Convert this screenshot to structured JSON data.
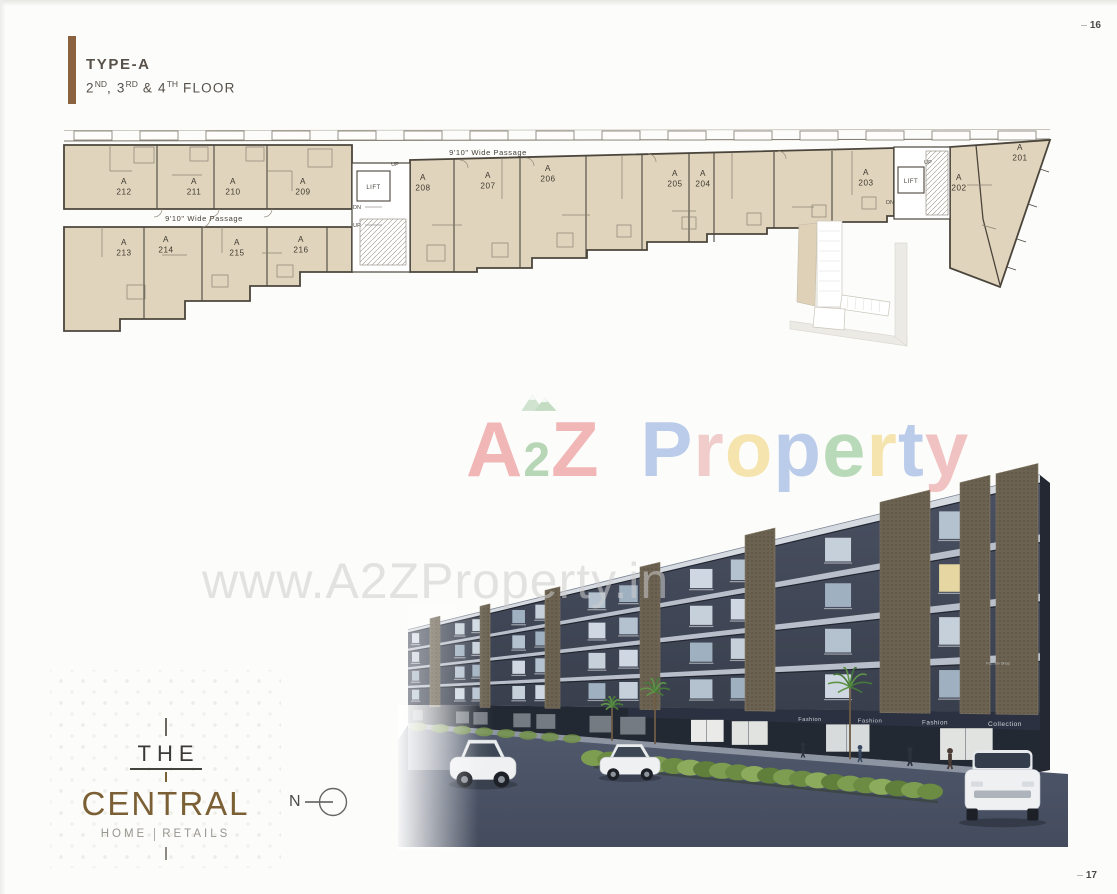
{
  "page": {
    "top_page_number": "16",
    "bottom_page_number": "17"
  },
  "header": {
    "title": "TYPE-A",
    "floor_parts": [
      {
        "text": "2",
        "sup": "ND"
      },
      {
        "text": ", 3",
        "sup": "RD"
      },
      {
        "text": " & 4",
        "sup": "TH"
      }
    ],
    "floor_suffix": " FLOOR",
    "accent_color": "#8a6240",
    "text_color": "#57514a"
  },
  "floor_plan": {
    "unit_block": "A",
    "unit_numbers": [
      "201",
      "202",
      "203",
      "204",
      "205",
      "206",
      "207",
      "208",
      "209",
      "210",
      "211",
      "212",
      "213",
      "214",
      "215",
      "216"
    ],
    "passage_label": "9'10\" Wide Passage",
    "lift_label": "LIFT",
    "up_label": "UP",
    "down_label": "DN",
    "unit_fill_color": "#e0d4bc",
    "wall_color": "#4b453c"
  },
  "watermarks": {
    "brand_opacity": 0.4,
    "brand_letters": [
      {
        "ch": "A",
        "color": "#e05252"
      },
      {
        "ch": "2",
        "color": "#4f9e52",
        "small": true,
        "peaks": true
      },
      {
        "ch": "Z",
        "color": "#e05252"
      },
      {
        "ch": " ",
        "color": "#000000"
      },
      {
        "ch": "P",
        "color": "#5b85d6"
      },
      {
        "ch": "r",
        "color": "#e08585"
      },
      {
        "ch": "o",
        "color": "#eec23f"
      },
      {
        "ch": "p",
        "color": "#5b85d6"
      },
      {
        "ch": "e",
        "color": "#57a957"
      },
      {
        "ch": "r",
        "color": "#eec23f"
      },
      {
        "ch": "t",
        "color": "#5b85d6"
      },
      {
        "ch": "y",
        "color": "#e07070"
      }
    ],
    "url_text": "www.A2ZProperty.in",
    "url_color": "#cdcdcd"
  },
  "render": {
    "shop_signs": [
      "Fashion",
      "Fashion",
      "Fashion",
      "Collection"
    ],
    "upper_sign": "Fashion Shop"
  },
  "logo": {
    "top_word": "THE",
    "main_word": "CENTRAL",
    "tagline_left": "HOME",
    "tagline_right": "RETAILS",
    "main_color": "#7c6035",
    "dark_color": "#3c3a36",
    "tagline_color": "#98958e"
  },
  "compass": {
    "label": "N"
  }
}
